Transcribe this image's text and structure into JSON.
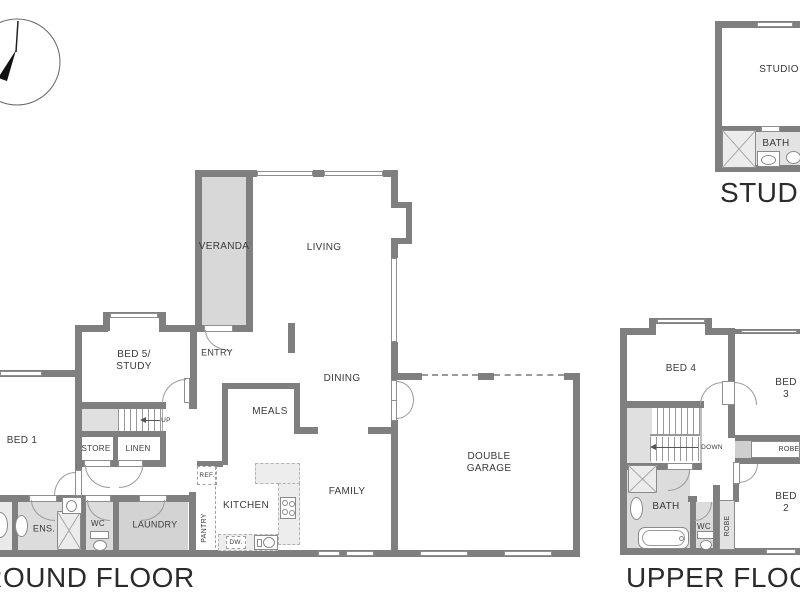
{
  "canvas": {
    "width": 800,
    "height": 600,
    "background": "#ffffff"
  },
  "colors": {
    "wall": "#7f7f7f",
    "veranda_fill": "#d8d8d8",
    "wet_room_fill": "#dcdcdc",
    "laundry_fill": "#d3d3d3",
    "landing_fill": "#e0e0e0",
    "bench_fill": "#ededed",
    "label_text": "#3a3a3a",
    "caption_text": "#2b2b2b"
  },
  "compass": {
    "icon": "north-arrow-icon"
  },
  "ground_floor": {
    "caption": "GROUND FLOOR",
    "rooms": {
      "veranda": "VERANDA",
      "living": "LIVING",
      "entry": "ENTRY",
      "bed5": "BED 5/\nSTUDY",
      "bed1": "BED 1",
      "up": "UP",
      "store": "STORE",
      "linen": "LINEN",
      "ens": "ENS.",
      "wc": "WC",
      "laundry": "LAUNDRY",
      "pantry": "PANTRY",
      "ref": "REF.",
      "kitchen": "KITCHEN",
      "dw": "DW.",
      "meals": "MEALS",
      "dining": "DINING",
      "family": "FAMILY",
      "garage": "DOUBLE\nGARAGE"
    }
  },
  "upper_floor": {
    "caption": "UPPER FLOOR",
    "rooms": {
      "bed4": "BED 4",
      "bed3": "BED 3",
      "bed2": "BED 2",
      "down": "DOWN",
      "robe_bed3": "ROBE",
      "robe_bed2": "ROBE",
      "bath": "BATH",
      "wc": "WC"
    }
  },
  "studio": {
    "caption": "STUDIO",
    "rooms": {
      "studio": "STUDIO",
      "bath": "BATH"
    }
  }
}
